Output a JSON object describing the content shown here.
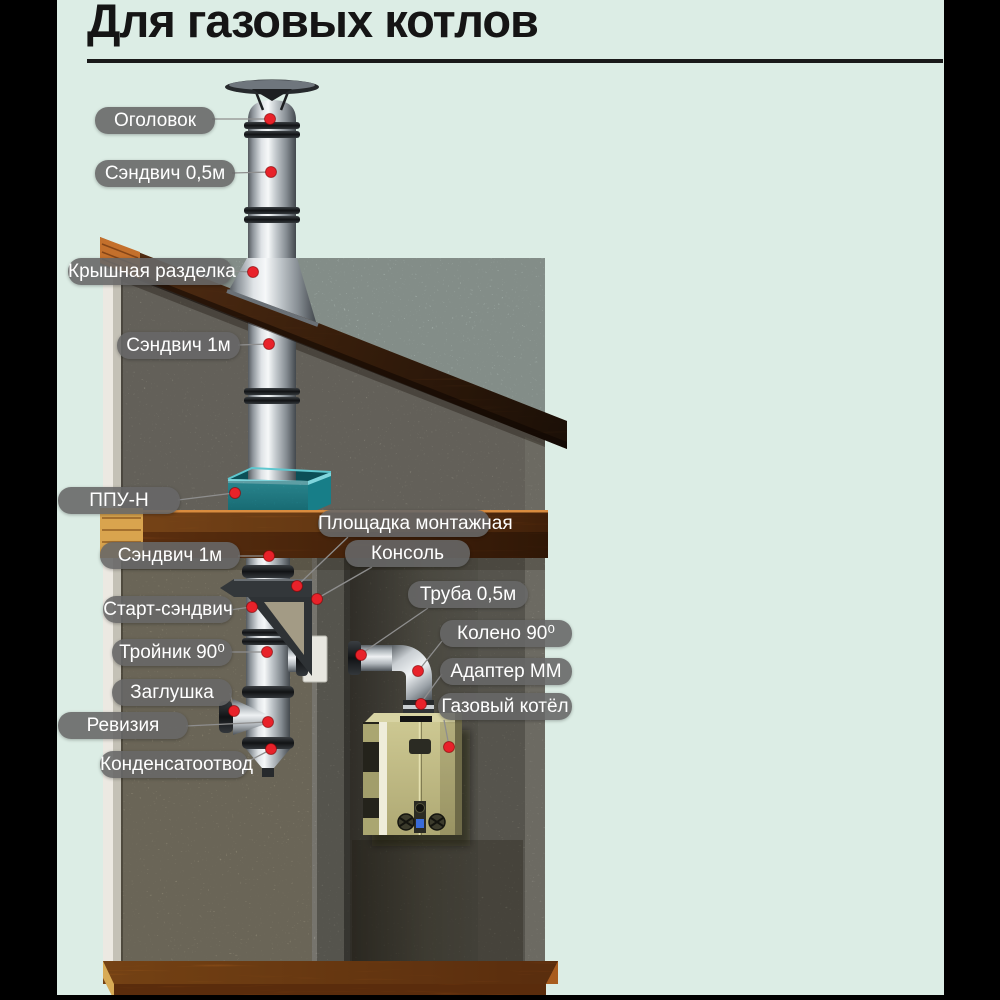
{
  "title": "Для газовых котлов",
  "callouts": [
    {
      "text": "Оголовок"
    },
    {
      "text": "Сэндвич 0,5м"
    },
    {
      "text": "Крышная разделка"
    },
    {
      "text": "Сэндвич 1м"
    },
    {
      "text": "ППУ-Н"
    },
    {
      "text": "Площадка монтажная"
    },
    {
      "text": "Консоль"
    },
    {
      "text": "Сэндвич 1м"
    },
    {
      "text": "Старт-сэндвич"
    },
    {
      "text": "Тройник 90⁰"
    },
    {
      "text": "Заглушка"
    },
    {
      "text": "Ревизия"
    },
    {
      "text": "Конденсатоотвод"
    },
    {
      "text": "Труба 0,5м"
    },
    {
      "text": "Колено 90⁰"
    },
    {
      "text": "Адаптер ММ"
    },
    {
      "text": "Газовый котёл"
    }
  ],
  "colors": {
    "background": "#dcede5",
    "frame_bars": "#000000",
    "label_background": "#676767",
    "label_text": "#ffffff",
    "callout_dot": "#e8222a",
    "ppu_box_teal": "#2aa3ae",
    "roof_wood": "#8f4f22",
    "boiler_khaki": "#c9c48e"
  }
}
